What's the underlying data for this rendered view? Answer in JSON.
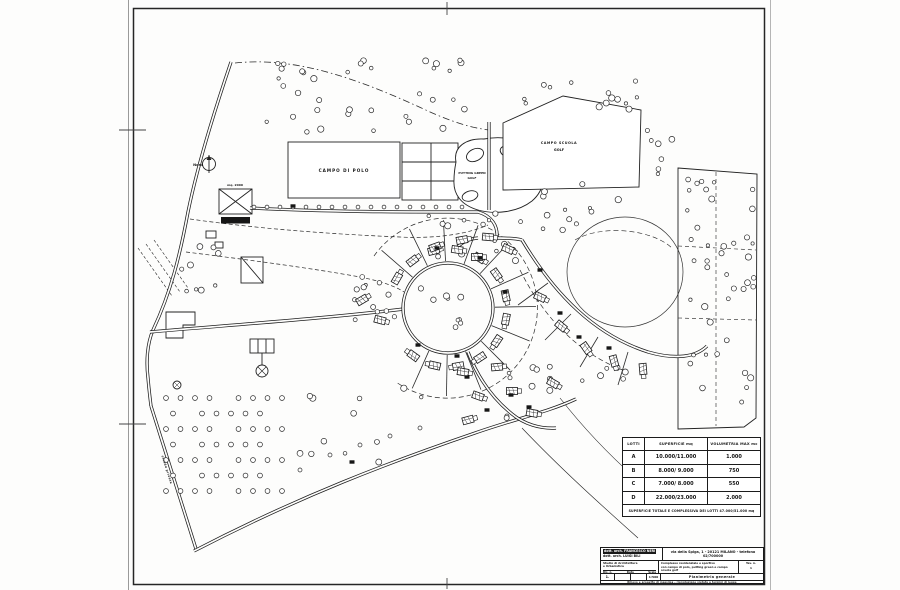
{
  "map": {
    "north_label": "Nord",
    "polo_field_label": "CAMPO DI POLO",
    "putting_green_label_line1": "PUTTING GREEN",
    "putting_green_label_line2": "GOLF",
    "golf_school_label_line1": "CAMPO SCUOLA",
    "golf_school_label_line2": "GOLF",
    "club_house_area_label": "mq. 2000",
    "club_house_label": "CLUB HOUSE",
    "private_road_label": "strada privata"
  },
  "lots_table": {
    "headers": [
      "LOTTI",
      "SUPERFICIE mq",
      "VOLUMETRIA MAX mc"
    ],
    "rows": [
      {
        "lot": "A",
        "superficie": "10.000/11.000",
        "volumetria": "1.000"
      },
      {
        "lot": "B",
        "superficie": "8.000/ 9.000",
        "volumetria": "750"
      },
      {
        "lot": "C",
        "superficie": "7.000/ 8.000",
        "volumetria": "550"
      },
      {
        "lot": "D",
        "superficie": "22.000/23.000",
        "volumetria": "2.000"
      }
    ],
    "footnote": "SUPERFICIE TOTALE E COMPLESSIVA DEI LOTTI 47.000/51.000 mq"
  },
  "title_block": {
    "architect_line1": "dott. arch. FRANCESCO NERI",
    "architect_line2": "dott. arch. LUIGI BILI",
    "address": "via della Spiga, 1 - 20121 MILANO - telefono 02/700000",
    "studio_line1": "Studio di Architettura",
    "studio_line2": "e Urbanistica",
    "col_dis_label": "Dis. n.",
    "col_data_label": "Data",
    "col_scala_label": "Scala",
    "rev_value": "1.",
    "scala_value": "1:500",
    "project_line1": "Complesso residenziale e sportivo",
    "project_line2": "con campo di polo, putting green e campo scuola golf",
    "project_line3": "Proprietà - Società Immobiliare S.p.A.",
    "tav_label": "Tav. n.",
    "tav_value": "1",
    "drawing_title": "Planimetria generale",
    "footer_note": "Rilievo e progetto di massima - riproduzione vietata a termini di legge"
  }
}
